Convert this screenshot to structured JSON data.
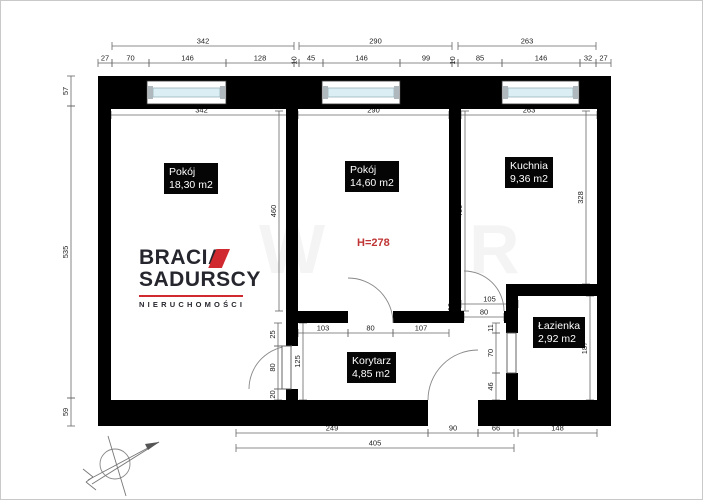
{
  "plan": {
    "rooms": [
      {
        "name": "Pokój",
        "area": "18,30 m2",
        "x": 163,
        "y": 162
      },
      {
        "name": "Pokój",
        "area": "14,60 m2",
        "x": 344,
        "y": 160
      },
      {
        "name": "Kuchnia",
        "area": "9,36 m2",
        "x": 504,
        "y": 156
      },
      {
        "name": "Łazienka",
        "area": "2,92 m2",
        "x": 532,
        "y": 316
      },
      {
        "name": "Korytarz",
        "area": "4,85 m2",
        "x": 346,
        "y": 351
      }
    ],
    "height_note": {
      "t": "H=278",
      "x": 356,
      "y": 236,
      "color": "#bf3434"
    },
    "walls": [
      {
        "x": 97,
        "y": 75,
        "w": 513,
        "h": 33
      },
      {
        "x": 97,
        "y": 75,
        "w": 13,
        "h": 350
      },
      {
        "x": 596,
        "y": 75,
        "w": 14,
        "h": 350
      },
      {
        "x": 97,
        "y": 399,
        "w": 330,
        "h": 26
      },
      {
        "x": 477,
        "y": 399,
        "w": 133,
        "h": 26
      },
      {
        "x": 285,
        "y": 108,
        "w": 12,
        "h": 237
      },
      {
        "x": 285,
        "y": 388,
        "w": 12,
        "h": 11
      },
      {
        "x": 297,
        "y": 310,
        "w": 50,
        "h": 12
      },
      {
        "x": 392,
        "y": 310,
        "w": 71,
        "h": 12
      },
      {
        "x": 448,
        "y": 108,
        "w": 12,
        "h": 214
      },
      {
        "x": 503,
        "y": 310,
        "w": 14,
        "h": 12
      },
      {
        "x": 505,
        "y": 295,
        "w": 12,
        "h": 37
      },
      {
        "x": 505,
        "y": 372,
        "w": 12,
        "h": 27
      },
      {
        "x": 505,
        "y": 283,
        "w": 91,
        "h": 12
      }
    ],
    "windows": [
      {
        "x": 146,
        "y": 80,
        "w": 79,
        "h": 23
      },
      {
        "x": 321,
        "y": 80,
        "w": 78,
        "h": 23
      },
      {
        "x": 501,
        "y": 80,
        "w": 77,
        "h": 23
      }
    ],
    "door_arcs": [
      {
        "d": "M291,345 A43,43 0 0 0 248,388"
      },
      {
        "d": "M392,322 A45,45 0 0 0 347,277"
      },
      {
        "d": "M503,310 A40,40 0 0 0 463,270"
      },
      {
        "d": "M427,399 A50,50 0 0 1 477,349"
      }
    ],
    "door_leaves": [
      {
        "x": 281,
        "y": 345,
        "w": 9,
        "h": 43
      },
      {
        "x": 506,
        "y": 332,
        "w": 9,
        "h": 40
      }
    ],
    "dims_h": [
      {
        "x1": 111,
        "x2": 293,
        "y": 45,
        "t": "342"
      },
      {
        "x1": 298,
        "x2": 451,
        "y": 45,
        "t": "290"
      },
      {
        "x1": 457,
        "x2": 595,
        "y": 45,
        "t": "263"
      },
      {
        "x1": 97,
        "x2": 111,
        "y": 62,
        "t": "27"
      },
      {
        "x1": 111,
        "x2": 148,
        "y": 62,
        "t": "70"
      },
      {
        "x1": 148,
        "x2": 225,
        "y": 62,
        "t": "146"
      },
      {
        "x1": 225,
        "x2": 293,
        "y": 62,
        "t": "128"
      },
      {
        "x1": 293,
        "x2": 298,
        "y": 62,
        "t": "10",
        "rot": true
      },
      {
        "x1": 298,
        "x2": 322,
        "y": 62,
        "t": "45"
      },
      {
        "x1": 322,
        "x2": 399,
        "y": 62,
        "t": "146"
      },
      {
        "x1": 399,
        "x2": 451,
        "y": 62,
        "t": "99"
      },
      {
        "x1": 451,
        "x2": 457,
        "y": 62,
        "t": "10",
        "rot": true
      },
      {
        "x1": 457,
        "x2": 501,
        "y": 62,
        "t": "85"
      },
      {
        "x1": 501,
        "x2": 579,
        "y": 62,
        "t": "146"
      },
      {
        "x1": 579,
        "x2": 595,
        "y": 62,
        "t": "32"
      },
      {
        "x1": 595,
        "x2": 610,
        "y": 62,
        "t": "27"
      },
      {
        "x1": 110,
        "x2": 291,
        "y": 114,
        "t": "342"
      },
      {
        "x1": 297,
        "x2": 448,
        "y": 114,
        "t": "290"
      },
      {
        "x1": 460,
        "x2": 596,
        "y": 114,
        "t": "263"
      },
      {
        "x1": 297,
        "x2": 347,
        "y": 332,
        "t": "103"
      },
      {
        "x1": 347,
        "x2": 392,
        "y": 332,
        "t": "80"
      },
      {
        "x1": 392,
        "x2": 448,
        "y": 332,
        "t": "107"
      },
      {
        "x1": 460,
        "x2": 517,
        "y": 303,
        "t": "105"
      },
      {
        "x1": 463,
        "x2": 503,
        "y": 316,
        "t": "80"
      },
      {
        "x1": 235,
        "x2": 427,
        "y": 432,
        "t": "249"
      },
      {
        "x1": 427,
        "x2": 477,
        "y": 432,
        "t": "90"
      },
      {
        "x1": 477,
        "x2": 513,
        "y": 432,
        "t": "66"
      },
      {
        "x1": 517,
        "x2": 596,
        "y": 432,
        "t": "148"
      },
      {
        "x1": 235,
        "x2": 513,
        "y": 447,
        "t": "405"
      }
    ],
    "dims_v": [
      {
        "y1": 75,
        "y2": 105,
        "x": 70,
        "t": "57"
      },
      {
        "y1": 105,
        "y2": 397,
        "x": 70,
        "t": "535"
      },
      {
        "y1": 397,
        "y2": 425,
        "x": 70,
        "t": "59"
      },
      {
        "y1": 110,
        "y2": 310,
        "x": 278,
        "t": "460"
      },
      {
        "y1": 110,
        "y2": 310,
        "x": 464,
        "t": "460"
      },
      {
        "y1": 110,
        "y2": 283,
        "x": 585,
        "t": "328"
      },
      {
        "y1": 295,
        "y2": 399,
        "x": 589,
        "t": "187"
      },
      {
        "y1": 322,
        "y2": 399,
        "x": 302,
        "t": "125"
      },
      {
        "y1": 322,
        "y2": 345,
        "x": 277,
        "t": "25"
      },
      {
        "y1": 345,
        "y2": 388,
        "x": 277,
        "t": "80"
      },
      {
        "y1": 388,
        "y2": 399,
        "x": 277,
        "t": "20"
      },
      {
        "y1": 322,
        "y2": 332,
        "x": 495,
        "t": "11"
      },
      {
        "y1": 332,
        "y2": 372,
        "x": 495,
        "t": "70"
      },
      {
        "y1": 372,
        "y2": 399,
        "x": 495,
        "t": "46"
      }
    ],
    "tiny_labels": [
      {
        "t": "10",
        "x": 452,
        "y": 306
      }
    ],
    "watermark": [
      {
        "ch": "W",
        "x": 258,
        "y": 272
      },
      {
        "ch": "R",
        "x": 468,
        "y": 272
      }
    ],
    "compass": {
      "circle": [
        114,
        463,
        15
      ],
      "lines": [
        [
          107,
          435,
          125,
          495
        ],
        [
          87,
          479,
          158,
          441
        ],
        [
          91,
          483,
          158,
          441
        ],
        [
          82,
          468,
          92,
          476
        ],
        [
          85,
          481,
          95,
          489
        ],
        [
          92,
          476,
          85,
          481
        ]
      ],
      "tip": "158,441 144,443 147,449"
    },
    "colors": {
      "wall": "#000000",
      "dim_line": "#666666",
      "arc": "#888888",
      "glass": "#daeef3",
      "glass_edge": "#9ab4bd",
      "cap": "#aeb8bd"
    }
  },
  "logo": {
    "line1": "BRACIA",
    "line2": "SADURSCY",
    "line3": "NIERUCHOMOŚCI",
    "x": 138,
    "y": 246,
    "accent": "#d02a30",
    "ink": "#26262e"
  }
}
